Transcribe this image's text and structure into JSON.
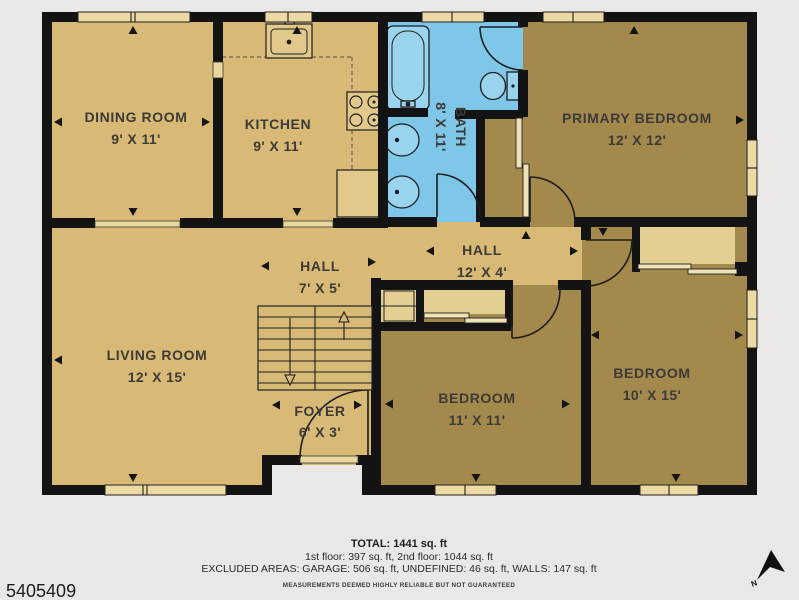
{
  "rooms": {
    "dining": {
      "name": "DINING ROOM",
      "dims": "9' X 11'"
    },
    "kitchen": {
      "name": "KITCHEN",
      "dims": "9' X 11'"
    },
    "bath": {
      "name": "BATH",
      "dims": "8' X 11'"
    },
    "primary": {
      "name": "PRIMARY BEDROOM",
      "dims": "12' X 12'"
    },
    "hall_small": {
      "name": "HALL",
      "dims": "7' X 5'"
    },
    "hall_main": {
      "name": "HALL",
      "dims": "12' X 4'"
    },
    "living": {
      "name": "LIVING ROOM",
      "dims": "12' X 15'"
    },
    "foyer": {
      "name": "FOYER",
      "dims": "6' X 3'"
    },
    "bedroom_a": {
      "name": "BEDROOM",
      "dims": "11' X 11'"
    },
    "bedroom_b": {
      "name": "BEDROOM",
      "dims": "10' X 15'"
    }
  },
  "footer": {
    "total": "TOTAL: 1441 sq. ft",
    "floors": "1st floor: 397 sq. ft, 2nd floor: 1044 sq. ft",
    "excluded": "EXCLUDED AREAS: GARAGE: 506 sq. ft, UNDEFINED: 46 sq. ft, WALLS: 147 sq. ft",
    "disclaimer": "MEASUREMENTS DEEMED HIGHLY RELIABLE BUT NOT GUARANTEED"
  },
  "mls_number": "5405409",
  "compass": {
    "north_label": "N"
  },
  "colors": {
    "floor_light": "#d8ba76",
    "floor_dark": "#a4894d",
    "closet": "#e4cf93",
    "bath_blue": "#7ec7e8",
    "wall": "#131313",
    "background": "#e9e8e6",
    "label_text": "#3c3a36"
  }
}
